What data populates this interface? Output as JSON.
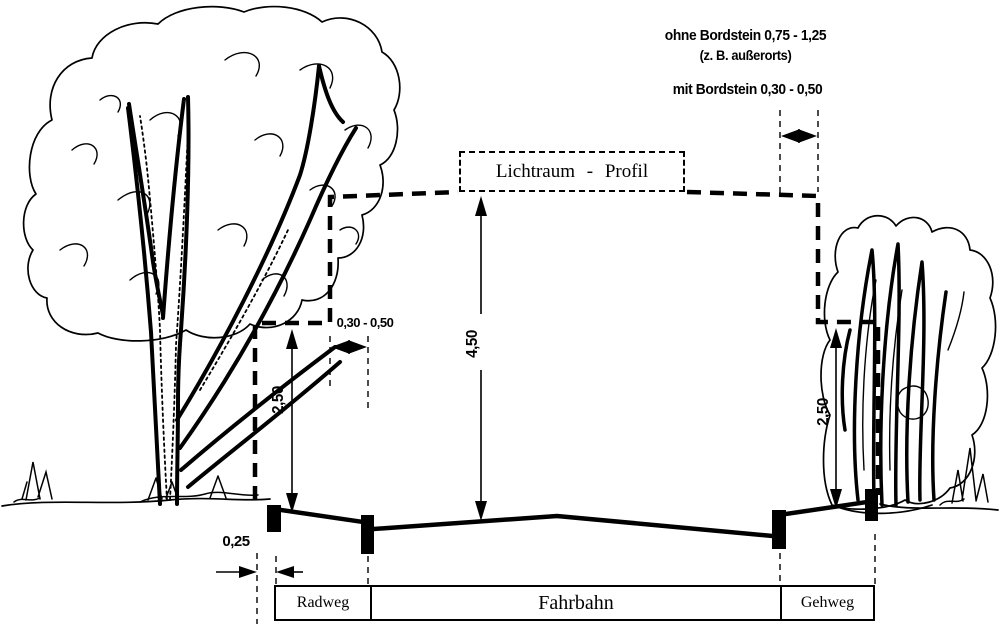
{
  "clearance_box": {
    "label": "Lichtraum - Profil"
  },
  "notes": {
    "ohne_bordstein": "ohne Bordstein 0,75 - 1,25",
    "ohne_bordstein_example": "(z. B. außerorts)",
    "mit_bordstein": "mit Bordstein 0,30 - 0,50"
  },
  "dimensions": {
    "clearance_height": "4,50",
    "side_height_left": "2,50",
    "side_height_right": "2,50",
    "verge_width": "0,30 - 0,50",
    "safety_strip": "0,25"
  },
  "zones": {
    "left": "Radweg",
    "center": "Fahrbahn",
    "right": "Gehweg"
  },
  "colors": {
    "ink": "#000000",
    "paper": "#ffffff"
  }
}
